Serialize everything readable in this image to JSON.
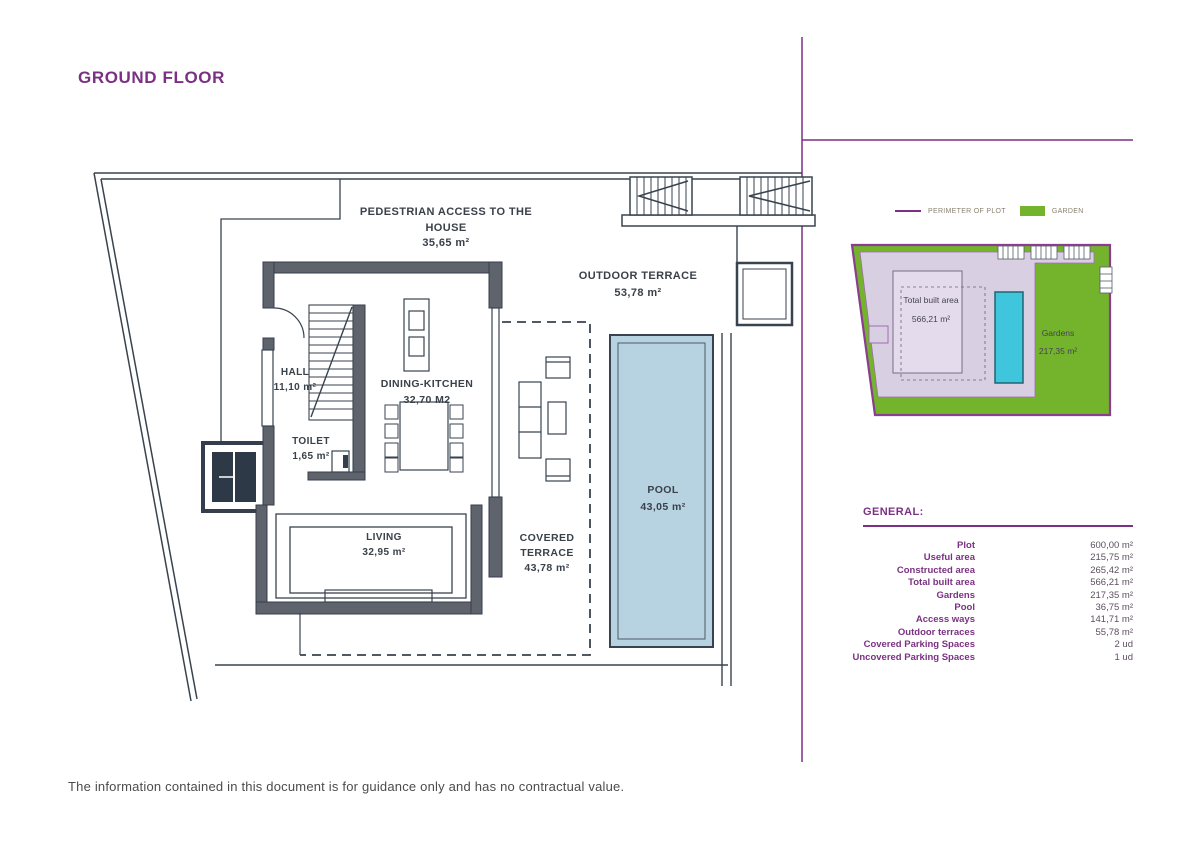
{
  "page": {
    "title": "GROUND FLOOR",
    "footer": "The information contained in this document is for guidance only and has no contractual value."
  },
  "plan": {
    "labels": {
      "pedestrian_access_line1": "PEDESTRIAN ACCESS TO THE",
      "pedestrian_access_line2": "HOUSE",
      "pedestrian_access_area": "35,65 m²",
      "outdoor_terrace": "OUTDOOR TERRACE",
      "outdoor_terrace_area": "53,78 m²",
      "hall": "HALL",
      "hall_area": "11,10 m²",
      "dining_kitchen": "DINING-KITCHEN",
      "dining_kitchen_area": "32,70 M2",
      "toilet": "TOILET",
      "toilet_area": "1,65 m²",
      "living": "LIVING",
      "living_area": "32,95 m²",
      "covered_terrace_line1": "COVERED",
      "covered_terrace_line2": "TERRACE",
      "covered_terrace_area": "43,78 m²",
      "pool": "POOL",
      "pool_area": "43,05 m²"
    }
  },
  "site_plan": {
    "total_built_area_label": "Total built area",
    "total_built_area_value": "566,21 m²",
    "gardens_label": "Gardens",
    "gardens_value": "217,35 m²"
  },
  "legend": {
    "items": [
      {
        "label": "PERIMETER OF PLOT",
        "swatch": "purple-line"
      },
      {
        "label": "GARDEN",
        "swatch": "green-box"
      }
    ]
  },
  "general": {
    "heading": "GENERAL:",
    "rows": [
      {
        "label": "Plot",
        "value": "600,00 m²"
      },
      {
        "label": "Useful area",
        "value": "215,75 m²"
      },
      {
        "label": "Constructed area",
        "value": "265,42 m²"
      },
      {
        "label": "Total built area",
        "value": "566,21 m²"
      },
      {
        "label": "Gardens",
        "value": "217,35 m²"
      },
      {
        "label": "Pool",
        "value": "36,75 m²"
      },
      {
        "label": "Access ways",
        "value": "141,71 m²"
      },
      {
        "label": "Outdoor terraces",
        "value": "55,78 m²"
      },
      {
        "label": "Covered Parking Spaces",
        "value": "2 ud"
      },
      {
        "label": "Uncovered Parking Spaces",
        "value": "1 ud"
      }
    ]
  },
  "colors": {
    "accent_purple": "#7b3183",
    "garden_green": "#74b42c",
    "pool_light_blue": "#b7d3e2",
    "site_pool_cyan": "#3fc6dc",
    "built_area_lavender": "#d9cfe2",
    "wall_gray": "#5f646c",
    "line_dark": "#39434f"
  }
}
